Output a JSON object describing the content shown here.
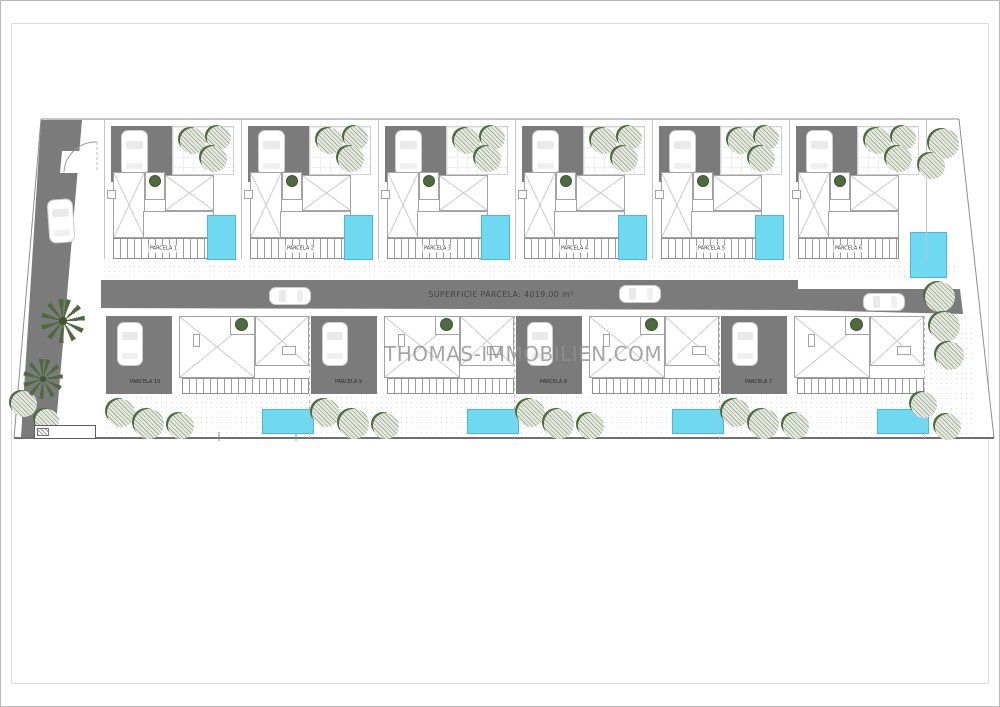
{
  "plan": {
    "watermark": "THOMAS-IMMOBILIEN.COM",
    "road_label": "SUPERFICIE PARCELA: 4019.00 m²",
    "parcels_top": [
      {
        "label": "PARCELA 1"
      },
      {
        "label": "PARCELA 2"
      },
      {
        "label": "PARCELA 3"
      },
      {
        "label": "PARCELA 4"
      },
      {
        "label": "PARCELA 5"
      },
      {
        "label": "PARCELA 6"
      }
    ],
    "parcels_bottom": [
      {
        "label": "PARCELA 10"
      },
      {
        "label": "PARCELA 9"
      },
      {
        "label": "PARCELA 8"
      },
      {
        "label": "PARCELA 7"
      }
    ],
    "colors": {
      "road": "#7b7b7b",
      "pool": "#6fd9f2",
      "pool_border": "#49b9d8",
      "tree_light": "#e7eae3",
      "tree_hatch": "#a3b097",
      "tree_dark": "#4e6a3e",
      "boundary_line": "#8e8e8e"
    }
  }
}
